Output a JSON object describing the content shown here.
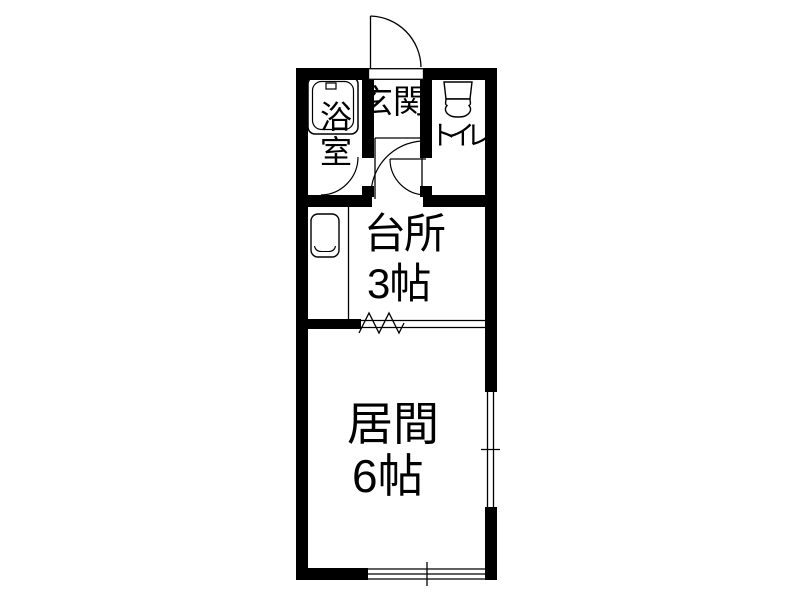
{
  "plan": {
    "rooms": {
      "bathroom": {
        "label": "浴室"
      },
      "entrance": {
        "label": "玄関"
      },
      "toilet": {
        "label": "トイレ"
      },
      "kitchen": {
        "label": "台所",
        "size": "3帖"
      },
      "living": {
        "label": "居間",
        "size": "6帖"
      }
    },
    "fixtures": [
      "bathtub-icon",
      "toilet-icon",
      "kitchen-sink-icon"
    ],
    "openings": [
      "entrance-door",
      "bathroom-door",
      "toilet-door",
      "kitchen-door",
      "accordion-partition",
      "window-right",
      "window-bottom"
    ],
    "colors": {
      "wall": "#000000",
      "line": "#000000",
      "background": "#ffffff",
      "text": "#000000"
    }
  }
}
